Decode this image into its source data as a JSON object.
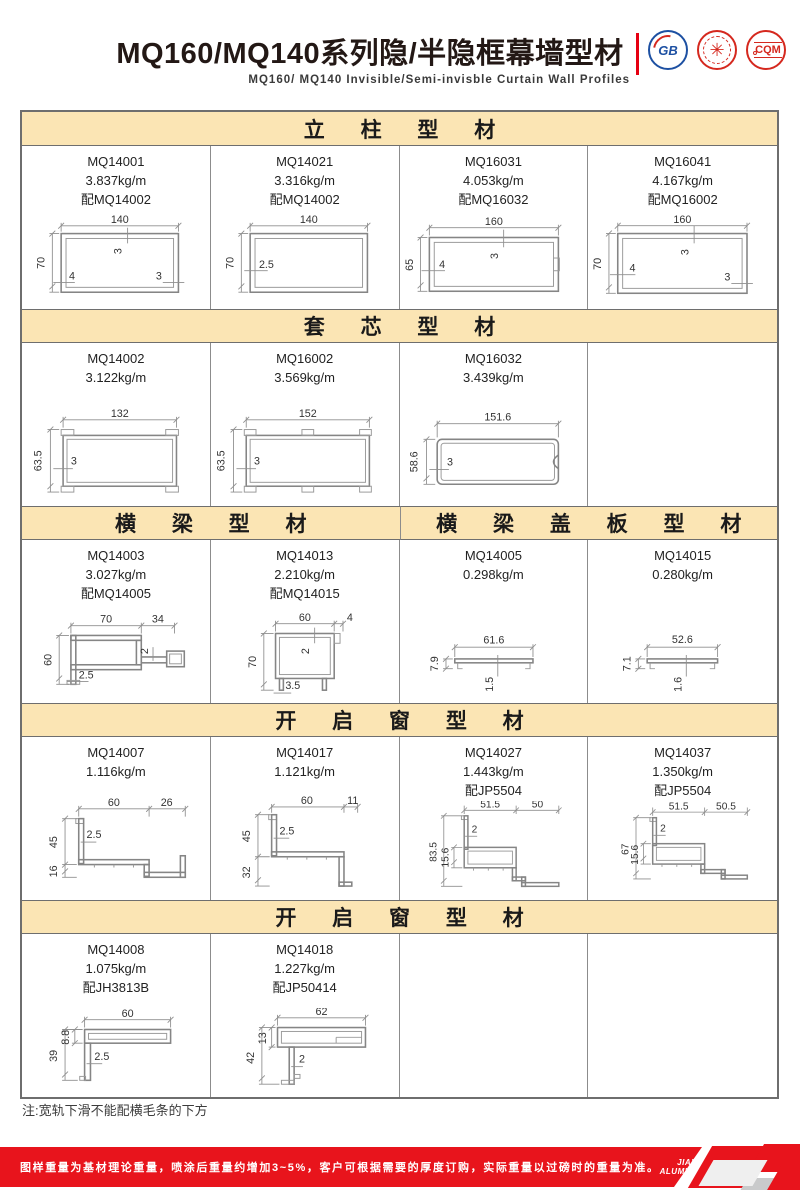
{
  "header": {
    "title": "MQ160/MQ140系列隐/半隐框幕墙型材",
    "subtitle": "MQ160/ MQ140  Invisible/Semi-invisble  Curtain  Wall  Profiles",
    "logos": [
      "GB",
      "✳",
      "CQM"
    ]
  },
  "sections": [
    {
      "header": "立柱型材",
      "cells": [
        {
          "model": "MQ14001",
          "weight": "3.837kg/m",
          "pair": "配MQ14002",
          "dims": {
            "w": "140",
            "h": "70",
            "a": "3",
            "b": "4",
            "c": "3"
          }
        },
        {
          "model": "MQ14021",
          "weight": "3.316kg/m",
          "pair": "配MQ14002",
          "dims": {
            "w": "140",
            "h": "70",
            "a": "2.5"
          }
        },
        {
          "model": "MQ16031",
          "weight": "4.053kg/m",
          "pair": "配MQ16032",
          "dims": {
            "w": "160",
            "h": "65",
            "a": "3",
            "b": "4"
          }
        },
        {
          "model": "MQ16041",
          "weight": "4.167kg/m",
          "pair": "配MQ16002",
          "dims": {
            "w": "160",
            "h": "70",
            "a": "3",
            "b": "4",
            "c": "3"
          }
        }
      ]
    },
    {
      "header": "套芯型材",
      "cells": [
        {
          "model": "MQ14002",
          "weight": "3.122kg/m",
          "dims": {
            "w": "132",
            "h": "63.5",
            "a": "3"
          }
        },
        {
          "model": "MQ16002",
          "weight": "3.569kg/m",
          "dims": {
            "w": "152",
            "h": "63.5",
            "a": "3"
          }
        },
        {
          "model": "MQ16032",
          "weight": "3.439kg/m",
          "dims": {
            "w": "151.6",
            "h": "58.6",
            "a": "3"
          }
        }
      ]
    },
    {
      "headers": [
        "横梁型材",
        "横梁盖板型材"
      ],
      "cells": [
        {
          "model": "MQ14003",
          "weight": "3.027kg/m",
          "pair": "配MQ14005",
          "dims": {
            "w": "70",
            "e": "34",
            "h": "60",
            "a": "2.5",
            "b": "2"
          }
        },
        {
          "model": "MQ14013",
          "weight": "2.210kg/m",
          "pair": "配MQ14015",
          "dims": {
            "w": "60",
            "e": "4",
            "h": "70",
            "a": "2",
            "b": "3.5"
          }
        },
        {
          "model": "MQ14005",
          "weight": "0.298kg/m",
          "dims": {
            "w": "61.6",
            "h": "7.9",
            "a": "1.5"
          }
        },
        {
          "model": "MQ14015",
          "weight": "0.280kg/m",
          "dims": {
            "w": "52.6",
            "h": "7.1",
            "a": "1.6"
          }
        }
      ]
    },
    {
      "header": "开启窗型材",
      "cells": [
        {
          "model": "MQ14007",
          "weight": "1.116kg/m",
          "dims": {
            "w": "60",
            "e": "26",
            "h": "45",
            "h2": "16",
            "a": "2.5"
          }
        },
        {
          "model": "MQ14017",
          "weight": "1.121kg/m",
          "dims": {
            "w": "60",
            "e": "11",
            "h": "45",
            "h2": "32",
            "a": "2.5"
          }
        },
        {
          "model": "MQ14027",
          "weight": "1.443kg/m",
          "pair": "配JP5504",
          "dims": {
            "w": "51.5",
            "e": "50",
            "h": "83.5",
            "h2": "15.6",
            "a": "2"
          }
        },
        {
          "model": "MQ14037",
          "weight": "1.350kg/m",
          "pair": "配JP5504",
          "dims": {
            "w": "51.5",
            "e": "50.5",
            "h": "67",
            "h2": "15.6",
            "a": "2"
          }
        }
      ]
    },
    {
      "header": "开启窗型材",
      "cells": [
        {
          "model": "MQ14008",
          "weight": "1.075kg/m",
          "pair": "配JH3813B",
          "dims": {
            "w": "60",
            "h": "39",
            "h2": "8.8",
            "a": "2.5"
          }
        },
        {
          "model": "MQ14018",
          "weight": "1.227kg/m",
          "pair": "配JP50414",
          "dims": {
            "w": "62",
            "h": "42",
            "h2": "13",
            "a": "2"
          }
        }
      ]
    }
  ],
  "note": "注:宽轨下滑不能配横毛条的下方",
  "footer": {
    "disclaimer": "图样重量为基材理论重量，喷涂后重量约增加3~5%，客户可根据需要的厚度订购，实际重量以过磅时的重量为准。",
    "brand_line1": "JIAHUA",
    "brand_line2": "ALUMINIUM",
    "page": "07"
  },
  "colors": {
    "accent_red": "#e60012",
    "section_header_bg": "#fbe5b4",
    "line_gray": "#8c8c8c"
  }
}
